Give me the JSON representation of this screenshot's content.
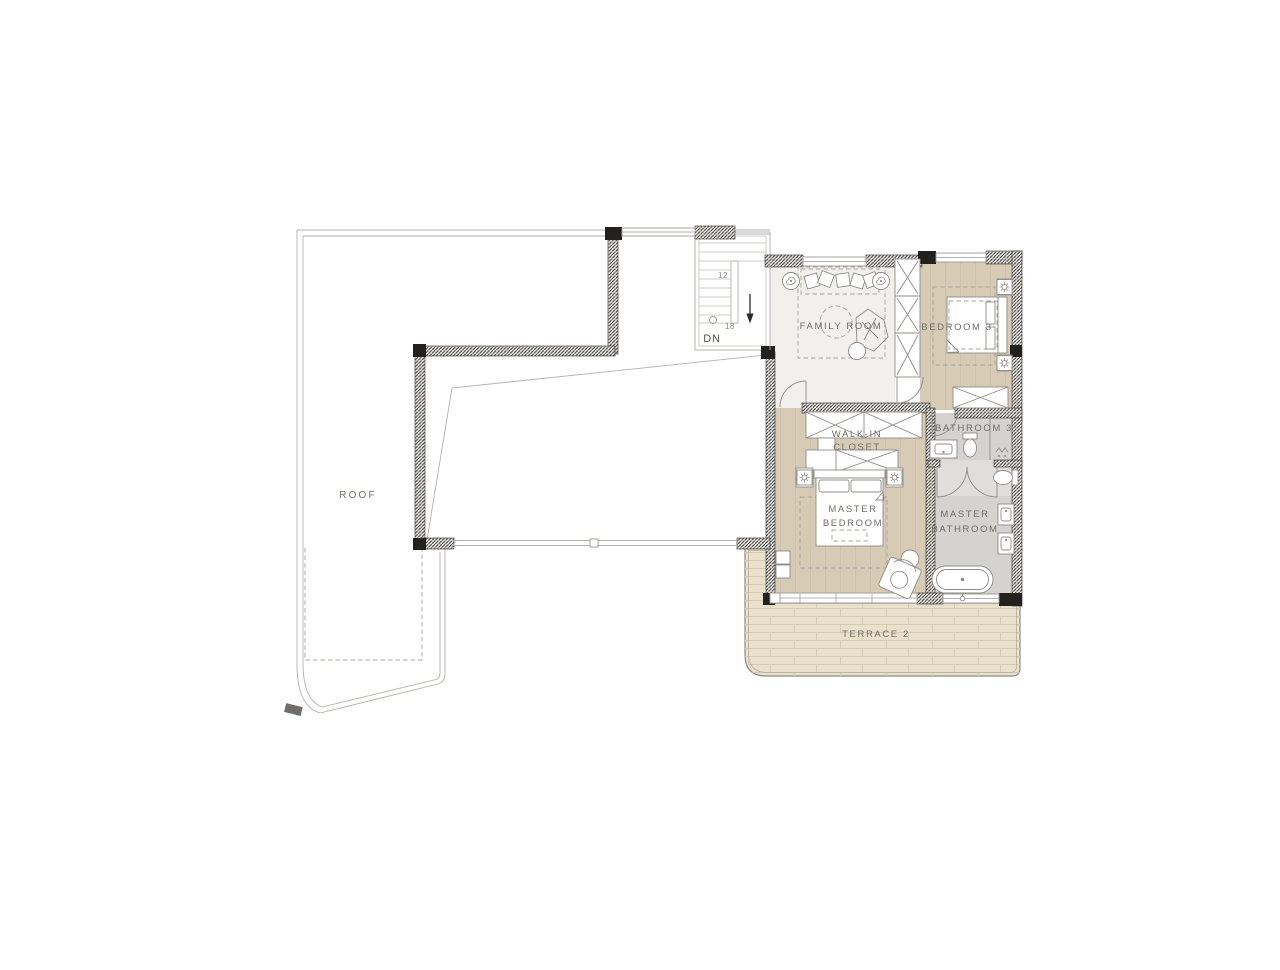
{
  "colors": {
    "background": "#ffffff",
    "wood_floor": "#d8cbb5",
    "family_room_floor": "#f1f0ed",
    "bathroom_floor": "#d4d3cf",
    "bathroom_floor_light": "#dfdedb",
    "terrace_floor": "#eae1cd",
    "wall_dark": "#262522",
    "line_light": "#b2b1ad",
    "line_mid": "#8d8c88",
    "text": "#6f6e68"
  },
  "rooms": {
    "roof": {
      "label": "ROOF"
    },
    "family_room": {
      "label": "FAMILY ROOM"
    },
    "bedroom_3": {
      "label": "BEDROOM 3"
    },
    "bathroom_3": {
      "label": "BATHROOM 3"
    },
    "walk_in_closet": {
      "line1": "WALK-IN",
      "line2": "CLOSET"
    },
    "master_bedroom": {
      "line1": "MASTER",
      "line2": "BEDROOM"
    },
    "master_bathroom": {
      "line1": "MASTER",
      "line2": "BATHROOM"
    },
    "terrace_2": {
      "label": "TERRACE 2"
    }
  },
  "stairs": {
    "direction_label": "DN",
    "count_upper": "12",
    "count_lower": "18"
  }
}
